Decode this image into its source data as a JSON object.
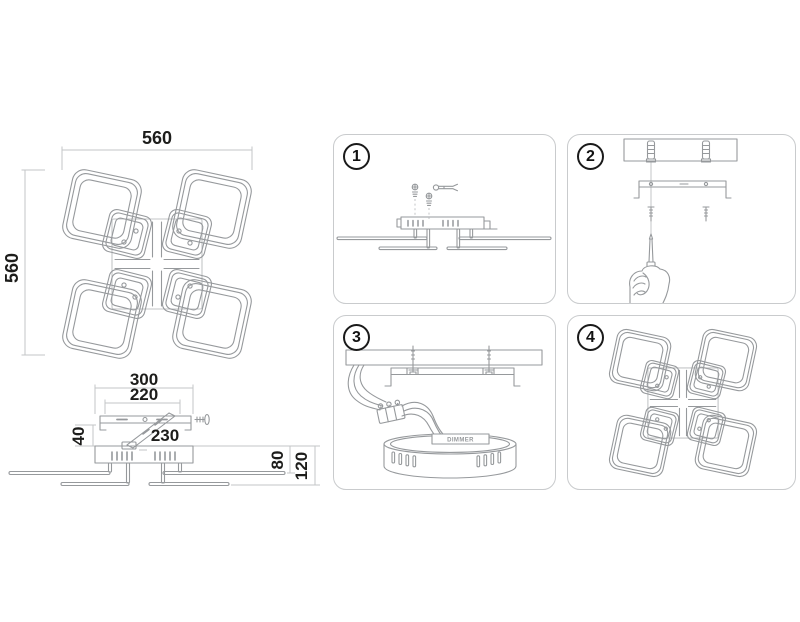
{
  "document": {
    "background": "#ffffff",
    "art_color": "#96999c",
    "light_line_color": "#c3c5c7",
    "text_color": "#1d1d1b",
    "panel_border_color": "#c9cbcd"
  },
  "top_view": {
    "width_label": "560",
    "height_label": "560"
  },
  "side_view": {
    "outer_width_label": "300",
    "inner_width_label": "220",
    "bar_length_label": "230",
    "canopy_height_label": "40",
    "arm_height_label": "80",
    "total_height_label": "120"
  },
  "steps": {
    "s1": {
      "number": "1"
    },
    "s2": {
      "number": "2"
    },
    "s3": {
      "number": "3",
      "driver_label": "DIMMER"
    },
    "s4": {
      "number": "4"
    }
  }
}
